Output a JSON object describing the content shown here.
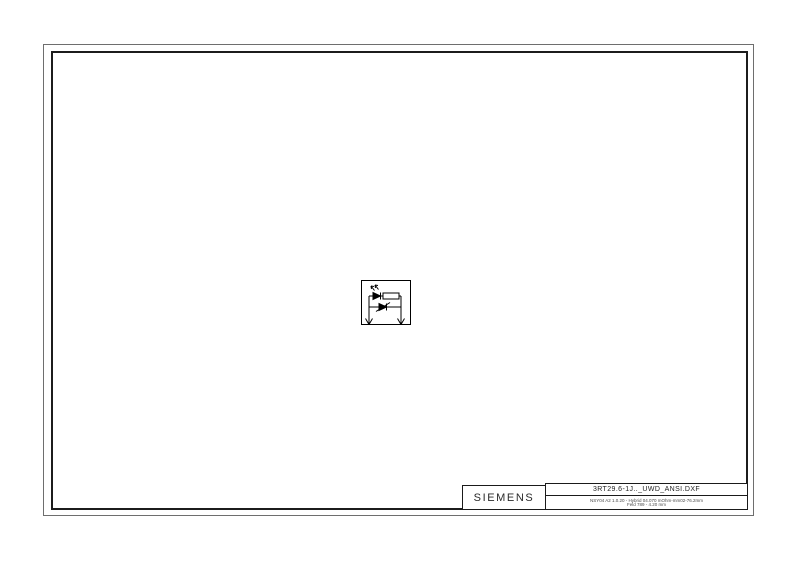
{
  "window": {
    "background": "#ffffff"
  },
  "frame": {
    "outer_color": "#6e6e6e",
    "inner_color": "#1c1c1c"
  },
  "schematic": {
    "symbol": "surge-suppressor-with-led-resistor-and-diode",
    "line_color": "#000000"
  },
  "title_block": {
    "brand": "SIEMENS",
    "filename": "3RT29.6-1J.._UWD_ANSI.DXF",
    "note_line1": "NSY04 A2 1.0.20 - Hybrid 04.070 mOhm-mm02-76.2mm",
    "note_line2": "Feld 789 - 4.20 mm"
  }
}
